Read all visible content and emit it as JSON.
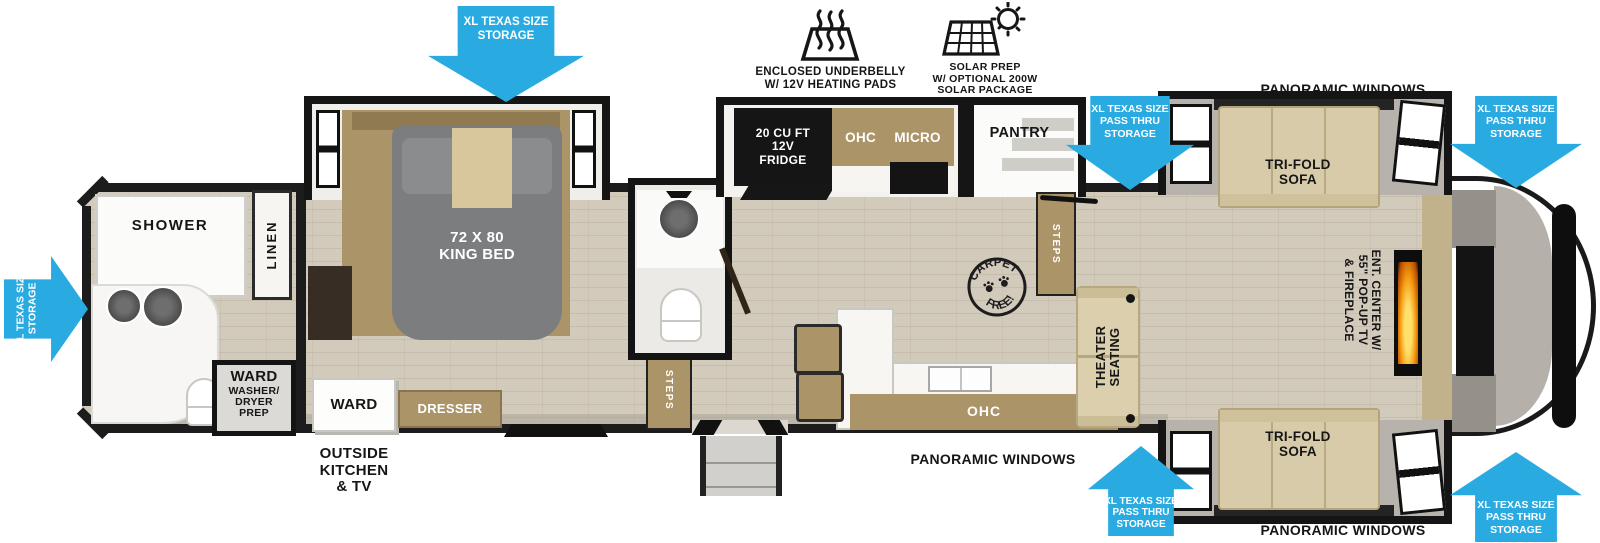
{
  "colors": {
    "arrow_blue": "#29ABE2",
    "wall_black": "#1c1c1c",
    "wood": "#ab9468",
    "floor": "#d2cabb",
    "sofa_beige": "#d8cba9",
    "bed_gray": "#7c7d7f",
    "flame_orange": "#f59a10"
  },
  "icons": {
    "underbelly_label": "ENCLOSED UNDERBELLY\nW/ 12V HEATING PADS",
    "solar_label": "SOLAR PREP\nW/ OPTIONAL 200W\nSOLAR PACKAGE"
  },
  "arrows": {
    "storage_left": "XL TEXAS SIZE\nSTORAGE",
    "storage_bedroom": "XL TEXAS SIZE\nSTORAGE",
    "passthru_top_mid": "XL TEXAS SIZE\nPASS THRU\nSTORAGE",
    "passthru_top_right": "XL TEXAS SIZE\nPASS THRU\nSTORAGE",
    "passthru_bottom_mid": "XL TEXAS SIZE\nPASS THRU\nSTORAGE",
    "passthru_bottom_right": "XL TEXAS SIZE\nPASS THRU\nSTORAGE"
  },
  "windows": {
    "top": "PANORAMIC WINDOWS",
    "bottom_mid": "PANORAMIC WINDOWS",
    "bottom_right": "PANORAMIC WINDOWS"
  },
  "labels": {
    "shower": "SHOWER",
    "linen": "LINEN",
    "ward_washer_title": "WARD",
    "ward_washer_sub": "WASHER/\nDRYER\nPREP",
    "king_bed": "72 X 80\nKING BED",
    "ward": "WARD",
    "dresser": "DRESSER",
    "outside_kitchen": "OUTSIDE\nKITCHEN\n& TV",
    "steps_bath": "STEPS",
    "steps_living": "STEPS",
    "fridge": "20 CU FT\n12V\nFRIDGE",
    "ohc_kitchen": "OHC",
    "micro": "MICRO",
    "pantry": "PANTRY",
    "ohc_island": "OHC",
    "theater": "THEATER\nSEATING",
    "trifold_top": "TRI-FOLD\nSOFA",
    "trifold_bottom": "TRI-FOLD\nSOFA",
    "ent_center": "ENT. CENTER W/\n55\" POP-UP TV\n& FIREPLACE"
  },
  "badge": {
    "top": "CARPET",
    "bottom": "FREE!"
  }
}
